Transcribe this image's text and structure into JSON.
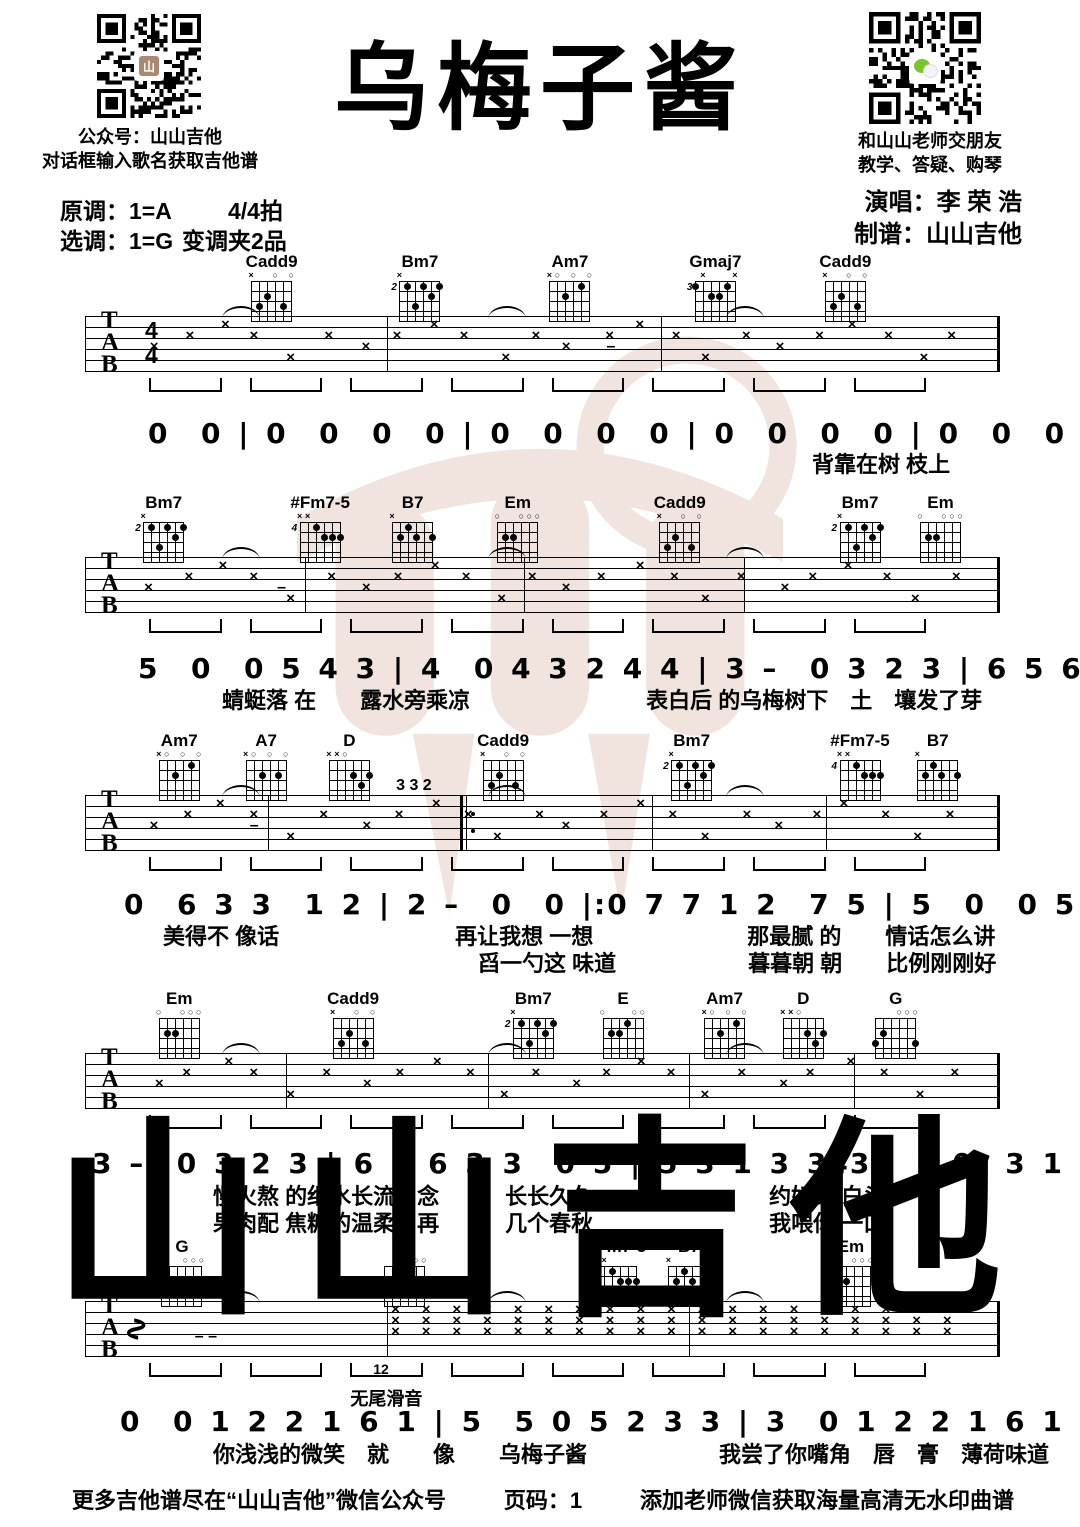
{
  "header": {
    "title": "乌梅子酱",
    "qr_left": {
      "caption1": "公众号：山山吉他",
      "caption2": "对话框输入歌名获取吉他谱"
    },
    "qr_right": {
      "caption1": "和山山老师交朋友",
      "caption2": "教学、答疑、购琴"
    },
    "original_key": "原调：1=A",
    "time": "4/4拍",
    "play_key": "选调：1=G",
    "capo": "变调夹2品",
    "singer": "演唱：李 荣 浩",
    "tabber": "制谱：山山吉他"
  },
  "watermark": {
    "text": "山山吉他",
    "color": "#f1e4de"
  },
  "notation": {
    "tab_letters": [
      "T",
      "A",
      "B"
    ],
    "time_sig": [
      "4",
      "4"
    ]
  },
  "chord_shapes": {
    "Cadd9": {
      "pos": "",
      "markers": [
        "x",
        "",
        "",
        "o",
        "",
        "o"
      ],
      "dots": [
        [
          2,
          3
        ],
        [
          3,
          2
        ],
        [
          5,
          3
        ]
      ]
    },
    "Bm7": {
      "pos": "2",
      "markers": [
        "x",
        "",
        "",
        "",
        "",
        ""
      ],
      "dots": [
        [
          2,
          1
        ],
        [
          3,
          3
        ],
        [
          4,
          1
        ],
        [
          5,
          2
        ],
        [
          6,
          1
        ]
      ]
    },
    "Am7": {
      "pos": "",
      "markers": [
        "x",
        "o",
        "",
        "o",
        "",
        "o"
      ],
      "dots": [
        [
          3,
          2
        ],
        [
          5,
          1
        ]
      ]
    },
    "Gmaj7": {
      "pos": "3",
      "markers": [
        "",
        "x",
        "",
        "",
        "",
        "x"
      ],
      "dots": [
        [
          1,
          1
        ],
        [
          3,
          2
        ],
        [
          4,
          2
        ],
        [
          5,
          1
        ]
      ]
    },
    "#Fm7-5": {
      "pos": "4",
      "markers": [
        "x",
        "x",
        "",
        "",
        "",
        ""
      ],
      "dots": [
        [
          3,
          1
        ],
        [
          4,
          2
        ],
        [
          5,
          2
        ],
        [
          6,
          2
        ]
      ]
    },
    "B7": {
      "pos": "",
      "markers": [
        "x",
        "",
        "",
        "",
        "",
        ""
      ],
      "dots": [
        [
          3,
          1
        ],
        [
          2,
          2
        ],
        [
          4,
          2
        ],
        [
          6,
          2
        ]
      ]
    },
    "Em": {
      "pos": "",
      "markers": [
        "o",
        "",
        "",
        "o",
        "o",
        "o"
      ],
      "dots": [
        [
          2,
          2
        ],
        [
          3,
          2
        ]
      ]
    },
    "A7": {
      "pos": "",
      "markers": [
        "x",
        "o",
        "",
        "o",
        "",
        "o"
      ],
      "dots": [
        [
          3,
          2
        ],
        [
          5,
          2
        ]
      ]
    },
    "D": {
      "pos": "",
      "markers": [
        "x",
        "x",
        "o",
        "",
        "",
        ""
      ],
      "dots": [
        [
          4,
          2
        ],
        [
          5,
          3
        ],
        [
          6,
          2
        ]
      ]
    },
    "E": {
      "pos": "",
      "markers": [
        "o",
        "",
        "",
        "",
        "o",
        "o"
      ],
      "dots": [
        [
          2,
          2
        ],
        [
          3,
          2
        ],
        [
          4,
          1
        ]
      ]
    },
    "G": {
      "pos": "",
      "markers": [
        "",
        "",
        "",
        "o",
        "o",
        "o"
      ],
      "dots": [
        [
          1,
          3
        ],
        [
          2,
          2
        ],
        [
          6,
          3
        ]
      ]
    }
  },
  "systems": [
    {
      "chords": [
        {
          "name": "Cadd9",
          "x": 20.4
        },
        {
          "name": "Bm7",
          "x": 36.6
        },
        {
          "name": "Am7",
          "x": 53.0
        },
        {
          "name": "Gmaj7",
          "x": 68.9
        },
        {
          "name": "Cadd9",
          "x": 83.1
        }
      ],
      "annotations": [
        {
          "t": "–",
          "x": 57,
          "dy": 22
        }
      ]
    },
    {
      "chords": [
        {
          "name": "Bm7",
          "x": 8.6
        },
        {
          "name": "#Fm7-5",
          "x": 25.7
        },
        {
          "name": "B7",
          "x": 35.8
        },
        {
          "name": "Em",
          "x": 47.3
        },
        {
          "name": "Cadd9",
          "x": 65.0
        },
        {
          "name": "Bm7",
          "x": 84.7
        },
        {
          "name": "Em",
          "x": 93.5
        }
      ],
      "annotations": [
        {
          "t": "–",
          "x": 21,
          "dy": 22
        }
      ]
    },
    {
      "chords": [
        {
          "name": "Am7",
          "x": 10.3
        },
        {
          "name": "A7",
          "x": 19.8
        },
        {
          "name": "D",
          "x": 28.9
        },
        {
          "name": "Cadd9",
          "x": 45.7
        },
        {
          "name": "Bm7",
          "x": 66.3
        },
        {
          "name": "#Fm7-5",
          "x": 84.7
        },
        {
          "name": "B7",
          "x": 93.2
        }
      ],
      "annotations": [
        {
          "t": "3 3 2",
          "x": 34,
          "dy": -18
        },
        {
          "t": "–",
          "x": 18,
          "dy": 22
        }
      ]
    },
    {
      "chords": [
        {
          "name": "Em",
          "x": 10.3
        },
        {
          "name": "Cadd9",
          "x": 29.3
        },
        {
          "name": "Bm7",
          "x": 49.0
        },
        {
          "name": "E",
          "x": 58.8
        },
        {
          "name": "Am7",
          "x": 69.9
        },
        {
          "name": "D",
          "x": 78.5
        },
        {
          "name": "G",
          "x": 88.6
        }
      ],
      "annotations": []
    },
    {
      "chords": [
        {
          "name": "G",
          "x": 10.6
        },
        {
          "name": "G",
          "x": 34.9
        },
        {
          "name": "#Fm7-5",
          "x": 58.1
        },
        {
          "name": "B7",
          "x": 66.0
        },
        {
          "name": "Em",
          "x": 83.7
        }
      ],
      "annotations": [
        {
          "t": "–   –",
          "x": 12,
          "dy": 27
        },
        {
          "t": "12",
          "x": 31.5,
          "dy": 60,
          "fs": 14
        },
        {
          "t": "无尾滑音",
          "x": 29,
          "dy": 84,
          "fs": 18
        }
      ]
    }
  ],
  "score_lines": [
    {
      "numbers": "0  0 | 0  0  0  0 | 0  0  0  0 | 0  0  0  0 | 0  0  0  0 | 0 7 7 1 2  7 5 |",
      "lyrics": [
        "背靠在树 枝上"
      ]
    },
    {
      "numbers": "5  0  0 5 4 3 | 4  0 4 3 2 4 4 | 3 –  0 3 2 3 | 6 5 6 3 3  0 5 | 5 3 1 3 3433 |",
      "lyrics": [
        "蜻蜓落 在　　露水旁乘凉　　　　　　　　表白后 的乌梅树下　土　壤发了芽"
      ]
    },
    {
      "numbers": "0  6 3 3  1 2 | 2 –  0  0 |:0 7 7 1 2  7 5 | 5  0  0 5 4 3 | 4  0 4 3 2 4 4 |",
      "lyrics": [
        "美得不 像话　　　　　　　　再让我想 一想　　　　　　　那最腻 的　　情话怎么讲",
        "舀一勺这 味道　　　　　　暮暮朝 朝　　比例刚刚好"
      ]
    },
    {
      "numbers": "3 –  0 3 2 3 | 6 5 6 3 3  0 5 | 5 3 1 3 3433  | 0  3 1 2  3 1 | 1 – – – |",
      "lyrics": [
        "慢火熬 的细水长流　念　　　长长久久　　　　　　　　约好到 白头",
        "果肉配 焦糖的温柔　再　　　几个春秋　　　　　　　　我喂你 一口"
      ]
    },
    {
      "numbers": "0  0 1 2 2 1 6 1 | 5  5 0 5 2 3 3 | 3  0 1 2 2 1 6 1 | 1  1 0 1 2 3 3 |",
      "lyrics": [
        "你浅浅的微笑　就　　像　　乌梅子酱　　　　　　我尝了你嘴角　唇　膏　薄荷味道"
      ]
    }
  ],
  "footer": {
    "left": "更多吉他谱尽在“山山吉他”微信公众号",
    "page": "页码：1",
    "right": "添加老师微信获取海量高清无水印曲谱"
  }
}
